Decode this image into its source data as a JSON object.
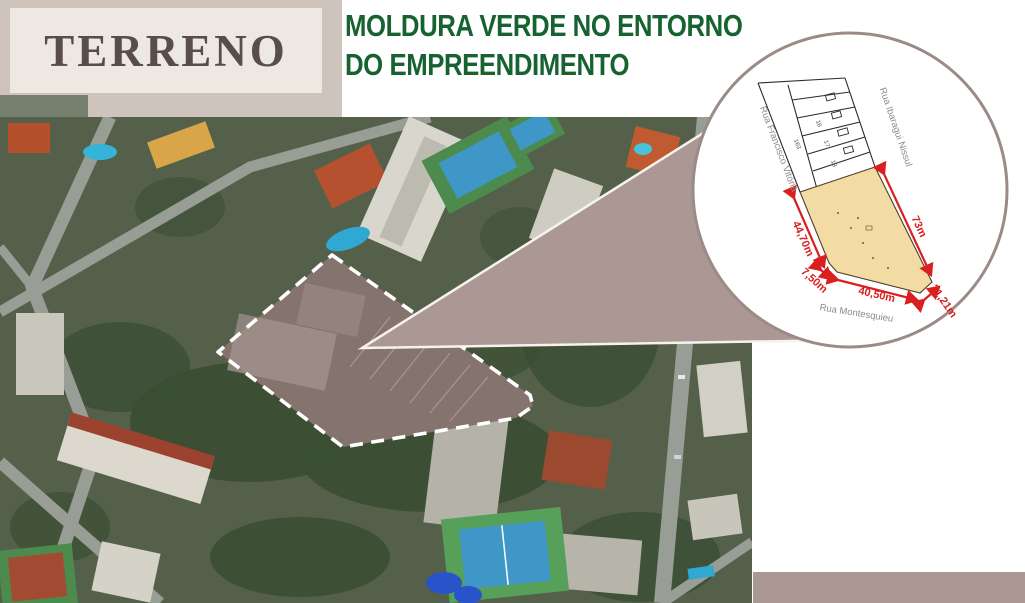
{
  "slide": {
    "title": "TERRENO",
    "heading_line1": "MOLDURA VERDE NO ENTORNO",
    "heading_line2": "DO EMPREENDIMENTO"
  },
  "inset": {
    "streets": {
      "left": "Rua Francisco Vitória",
      "right": "Rua Ibaragui Nissul",
      "bottom": "Rua Montesquieu"
    },
    "measurements": {
      "left": "44,70m",
      "bottom_small": "7,50m",
      "bottom": "40,50m",
      "corner": "21,21m",
      "right": "73m"
    },
    "lots": [
      "163",
      "16",
      "17",
      "18"
    ]
  },
  "colors": {
    "green_heading": "#166231",
    "title_text": "#584d48",
    "title_bg": "#eee8e3",
    "band": "#cfc4bb",
    "accent_square": "#75816e",
    "wedge": "#ab9894",
    "circle_border": "#9b8b86",
    "plot_fill": "#f2dca4",
    "red": "#d9201f",
    "street_label": "#8a8a8a",
    "boundary_dash": "#ffffff"
  }
}
